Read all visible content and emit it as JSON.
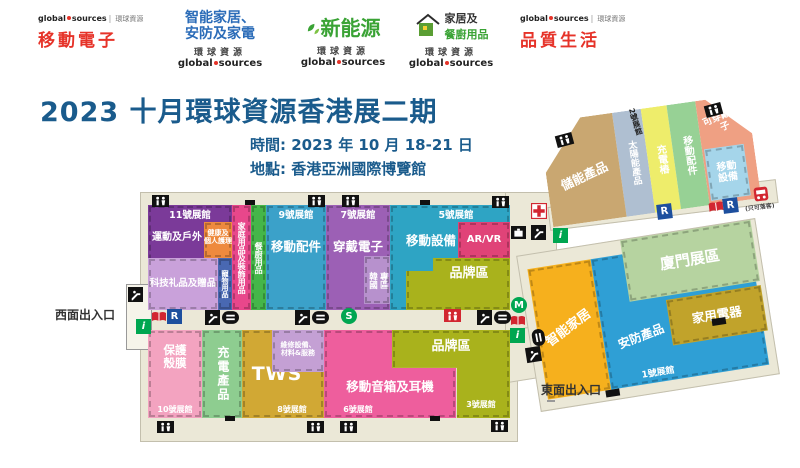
{
  "gs": {
    "word1": "global",
    "word2": "sources",
    "cn": "環球資源"
  },
  "logos": {
    "mobile": "移動電子",
    "smart1": "智能家居、",
    "smart2": "安防及家電",
    "energy": "新能源",
    "home1": "家居及",
    "home2": "餐廚用品",
    "life": "品質生活"
  },
  "title": {
    "main": "2023 十月環球資源香港展二期",
    "time": "時間: 2023 年 10 月 18-21 日",
    "venue": "地點: 香港亞洲國際博覽館"
  },
  "map": {
    "h11": {
      "header": "11號展館",
      "sports": "運動及戶外",
      "health1": "健康及",
      "health2": "個人護理",
      "gifts": "科技礼品及贈品",
      "pets": "寵物用品",
      "household": "家庭用品及裝飾用品",
      "kitchen": "餐廚用品"
    },
    "h9": {
      "header": "9號展館",
      "label": "移動配件"
    },
    "h7": {
      "header": "7號展館",
      "label": "穿戴電子",
      "korea1": "韓國",
      "korea2": "專區"
    },
    "h5": {
      "header": "5號展館",
      "label": "移動設備",
      "arvr": "AR/VR",
      "brand": "品牌區"
    },
    "h10": {
      "label": "保護殼膜",
      "footer": "10號展館"
    },
    "h8": {
      "charge": "充電產品",
      "tws": "TWS",
      "repair1": "維修設備、",
      "repair2": "材料&服務",
      "footer": "8號展館"
    },
    "h6": {
      "label": "移動音箱及耳機",
      "footer": "6號展館"
    },
    "h3": {
      "brand": "品牌區",
      "footer": "3號展館"
    },
    "h1": {
      "smart": "智能家居",
      "security": "安防產品",
      "xiamen": "廈門展區",
      "appliance": "家用電器",
      "footer": "1號展館"
    },
    "h2": {
      "header": "2號展館",
      "storage": "儲能產品",
      "solar": "太陽能產品",
      "charging": "充電樁",
      "accessories": "移動配件",
      "wearable": "可穿戴電子",
      "mobile": "移動設備"
    },
    "west": "西面出入口",
    "east": "東面出入口",
    "dropoff": "(只可落客)",
    "letters": {
      "r": "R",
      "s": "S",
      "m": "M",
      "i": "i"
    }
  },
  "palette": {
    "title_blue": "#1a5b8c",
    "logo_red": "#e63329",
    "logo_blue": "#2b6cb8",
    "logo_green": "#3aa335",
    "floor": "#ebe8d7",
    "h11_purple": "#7b3a99",
    "orange": "#ee8a3e",
    "lavender": "#c9a1da",
    "pet_blue": "#4968b2",
    "pink_strip": "#e8478b",
    "green_strip": "#45b649",
    "h9_blue": "#3ba1c9",
    "h7_purple": "#9c60b5",
    "korea_purple": "#b791cd",
    "h5_teal": "#2ea4c4",
    "arvr_magenta": "#e04378",
    "brand_olive": "#a9b21c",
    "h10_pink": "#f3a3c0",
    "h8_green": "#8ecd90",
    "tws_gold": "#d1a834",
    "repair_purple": "#c4a0d4",
    "h6_magenta": "#ee5e9d",
    "smart_yellow": "#f6b01d",
    "security_blue": "#2f9fd5",
    "xiamen_green": "#b6d3a0",
    "appliance_gold": "#c1a32b",
    "h2_tan": "#c9a771",
    "h2_steel": "#afbfd1",
    "h2_yellow": "#eeed6b",
    "h2_green": "#97d195",
    "h2_salmon": "#efa083",
    "h2_blue": "#a5d5ea",
    "icon_green": "#00a651",
    "icon_blue": "#1d4f9e",
    "icon_red": "#d22630"
  }
}
